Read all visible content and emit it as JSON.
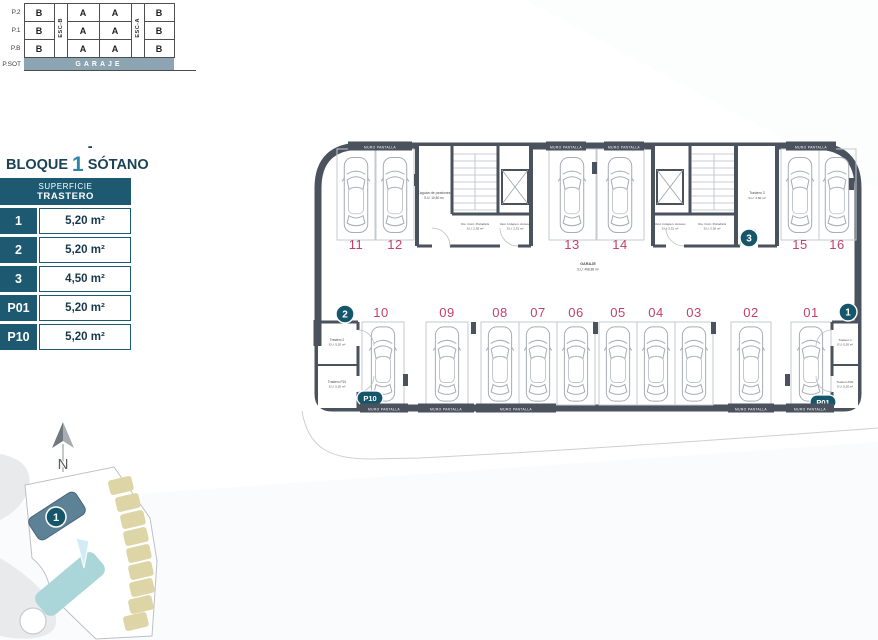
{
  "colors": {
    "accent_teal": "#1d5a71",
    "title_number_teal": "#2d85a8",
    "title_dark": "#1b4356",
    "spot_number": "#c2416b",
    "wall": "#4a525e",
    "garaje_band": "#8da4b2",
    "site_building_highlight": "#5d8195",
    "site_building_light": "#abd6d9",
    "site_pool": "#d3ebf7",
    "site_tan": "#ded5a6"
  },
  "schematic": {
    "floors": [
      "P.2",
      "P.1",
      "P.B"
    ],
    "sot_label": "P.SOT",
    "rows": [
      [
        "B",
        "A",
        "A",
        "B"
      ],
      [
        "B",
        "A",
        "A",
        "B"
      ],
      [
        "B",
        "A",
        "A",
        "B"
      ]
    ],
    "esc_left": "ESC-B",
    "esc_right": "ESC-A",
    "garaje": "GARAJE"
  },
  "legend": {
    "title_prefix": "BLOQUE",
    "title_number": "1",
    "title_suffix": "- SÓTANO",
    "header_top": "SUPERFICIE",
    "header_bottom": "TRASTERO",
    "rows": [
      {
        "id": "1",
        "area": "5,20 m²"
      },
      {
        "id": "2",
        "area": "5,20 m²"
      },
      {
        "id": "3",
        "area": "4,50 m²"
      },
      {
        "id": "P01",
        "area": "5,20 m²"
      },
      {
        "id": "P10",
        "area": "5,20 m²"
      }
    ]
  },
  "plan": {
    "spots_top": [
      "11",
      "12",
      "13",
      "14",
      "15",
      "16"
    ],
    "spots_bottom": [
      "10",
      "09",
      "08",
      "07",
      "06",
      "05",
      "04",
      "03",
      "02",
      "01"
    ],
    "badge_1": "1",
    "badge_2": "2",
    "badge_3": "3",
    "badge_p01": "P01",
    "badge_p10": "P10",
    "garaje_name": "GARAJE",
    "garaje_area": "S.U: 498,86 m²",
    "wall_label": "MURO PANTALLA",
    "rooms": {
      "zaguan_name": "Zaguán de peatones",
      "zaguan_area": "S.U: 10,80 m²",
      "cto_a_name": "Cto. Cont. Portabicis",
      "cto_a_area": "S.U: 2,30 m²",
      "vest_a_name": "Vest. Indepen. Acceso",
      "vest_a_area": "S.U: 2,31 m²",
      "vest_b_name": "Vest. Indepen. Acceso",
      "vest_b_area": "S.U: 2,31 m²",
      "cto_b_name": "Cto. Cont. Portabicis",
      "cto_b_area": "S.U: 2,30 m²",
      "t3_name": "Trastero 3",
      "t3_area": "S.U: 4,50 m²",
      "t2_name": "Trastero 2",
      "t2_area": "S.U: 5,20 m²",
      "p10_name": "Trastero P10",
      "p10_area": "S.U: 5,20 m²",
      "t1_name": "Trastero 1",
      "t1_area": "S.U: 5,20 m²",
      "p01_name": "Trastero P01",
      "p01_area": "S.U: 5,20 m²"
    }
  },
  "site_map": {
    "badge": "1",
    "north": "N"
  }
}
